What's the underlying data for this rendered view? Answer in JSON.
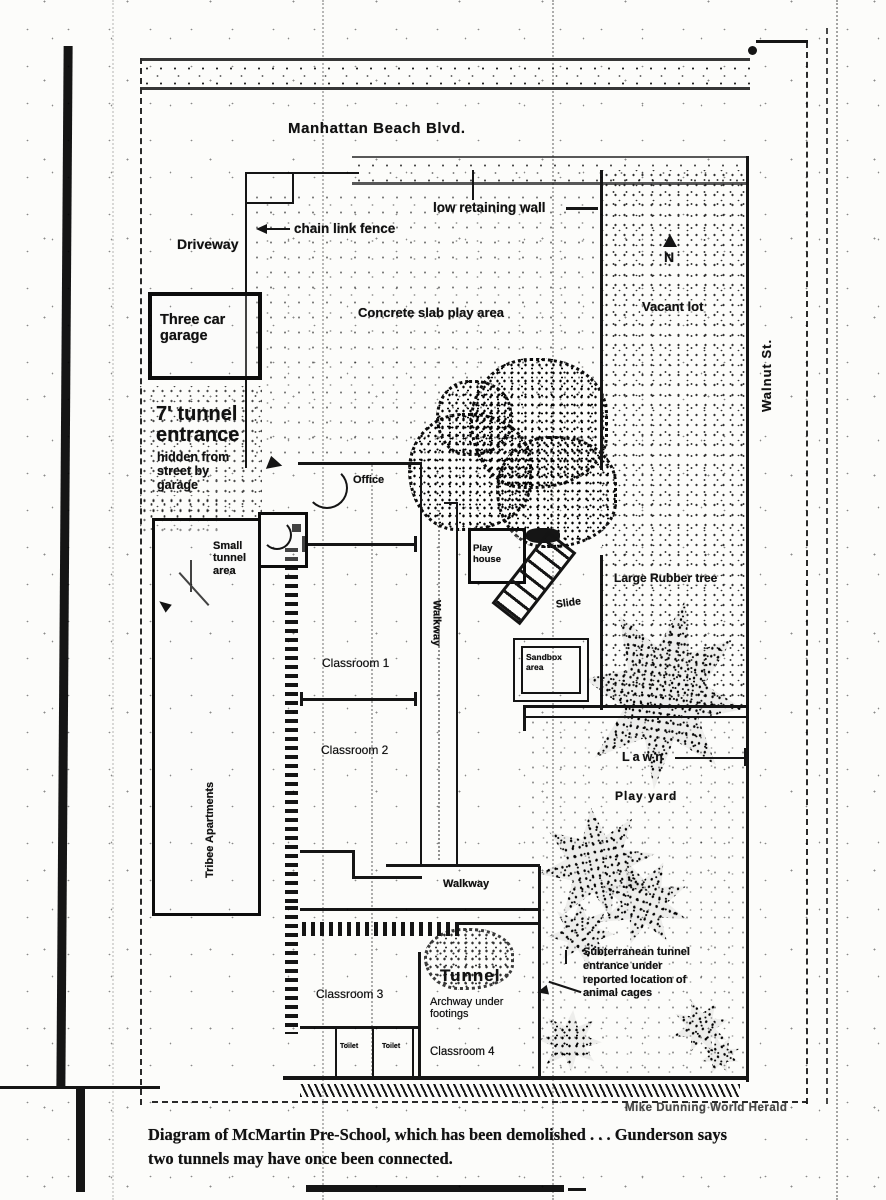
{
  "streets": {
    "main": "Manhattan Beach Blvd.",
    "side": "Walnut St."
  },
  "compass": {
    "north": "N"
  },
  "site": {
    "driveway": "Driveway",
    "garage": "Three car garage",
    "apartments": "Tribee Apartments",
    "vacant_lot": "Vacant lot",
    "concrete_slab": "Concrete slab play area",
    "chain_link_fence": "chain link fence",
    "low_retaining_wall": "low retaining wall",
    "lawn": "Lawn",
    "play_yard": "Play yard",
    "play_house": "Play house",
    "slide": "Slide",
    "rubber_tree": "Large Rubber tree",
    "sandbox": "Sandbox area"
  },
  "school": {
    "office": "Office",
    "classroom1": "Classroom 1",
    "classroom2": "Classroom 2",
    "classroom3": "Classroom 3",
    "classroom4": "Classroom 4",
    "walkway_vertical": "Walkway",
    "walkway_horizontal": "Walkway",
    "toilet_left": "Toilet",
    "toilet_right": "Toilet"
  },
  "tunnels": {
    "entrance_title": "7' tunnel entrance",
    "entrance_note": "hidden from street by garage",
    "small_tunnel": "Small tunnel area",
    "tunnel": "Tunnel",
    "archway": "Archway under footings",
    "subterranean": "Subterranean tunnel entrance under reported location of animal cages"
  },
  "footer": {
    "credit": "Mike Dunning World Herald",
    "caption_line1": "Diagram of McMartin Pre-School, which has been demolished . . . Gunderson says",
    "caption_line2": "two tunnels may have once been connected."
  },
  "colors": {
    "ink": "#141414",
    "paper": "#fcfcfa"
  }
}
